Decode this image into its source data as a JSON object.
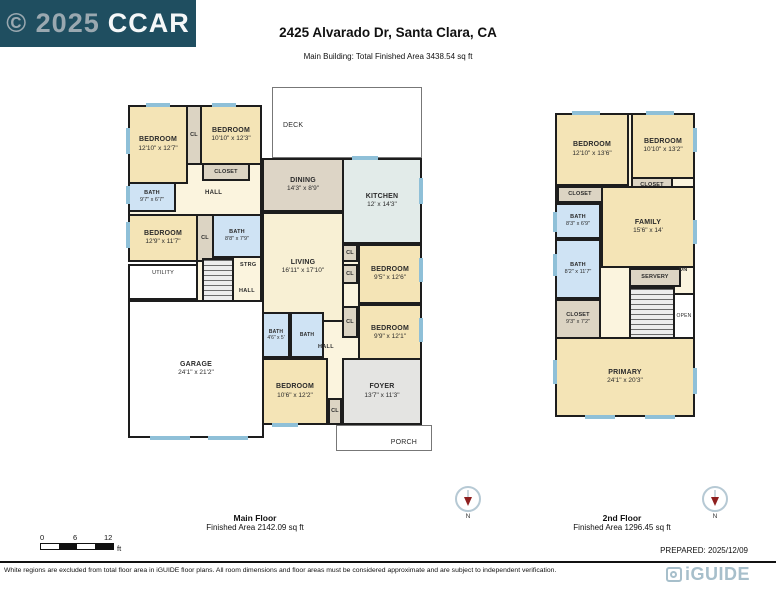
{
  "header": {
    "copyright_prefix": "© 2025",
    "copyright_suffix": "CCAR",
    "title": "2425 Alvarado Dr, Santa Clara, CA",
    "subtitle": "Main Building: Total Finished Area 3438.54 sq ft"
  },
  "main_floor": {
    "title": "Main Floor",
    "area": "Finished Area 2142.09 sq ft",
    "rooms": {
      "deck": "DECK",
      "porch": "PORCH",
      "bedroom1": {
        "name": "BEDROOM",
        "dims": "12'10\" x 12'7\""
      },
      "cl1": "CL",
      "bedroom2": {
        "name": "BEDROOM",
        "dims": "10'10\" x 12'3\""
      },
      "closet1": "CLOSET",
      "bath1": {
        "name": "BATH",
        "dims": "9'7\" x 6'7\""
      },
      "hall1": "HALL",
      "bedroom3": {
        "name": "BEDROOM",
        "dims": "12'9\" x 11'7\""
      },
      "cl2": "CL",
      "bath2": {
        "name": "BATH",
        "dims": "8'8\" x 7'9\""
      },
      "strg": "STRG",
      "hall2": "HALL",
      "utility": "UTILITY",
      "garage": {
        "name": "GARAGE",
        "dims": "24'1\" x 21'2\""
      },
      "dining": {
        "name": "DINING",
        "dims": "14'3\" x 8'9\""
      },
      "kitchen": {
        "name": "KITCHEN",
        "dims": "12' x 14'3\""
      },
      "living": {
        "name": "LIVING",
        "dims": "16'11\" x 17'10\""
      },
      "cl3": "CL",
      "cl4": "CL",
      "bedroom4": {
        "name": "BEDROOM",
        "dims": "9'5\" x 12'6\""
      },
      "cl5": "CL",
      "bedroom5": {
        "name": "BEDROOM",
        "dims": "9'9\" x 12'1\""
      },
      "hall3": "HALL",
      "bath3": {
        "name": "BATH",
        "dims": "4'6\" x 5'"
      },
      "bath4": "BATH",
      "bedroom6": {
        "name": "BEDROOM",
        "dims": "10'6\" x 12'2\""
      },
      "cl6": "CL",
      "foyer": {
        "name": "FOYER",
        "dims": "13'7\" x 11'3\""
      }
    }
  },
  "second_floor": {
    "title": "2nd Floor",
    "area": "Finished Area 1296.45 sq ft",
    "rooms": {
      "bedroomA": {
        "name": "BEDROOM",
        "dims": "12'10\" x 13'6\""
      },
      "bedroomB": {
        "name": "BEDROOM",
        "dims": "10'10\" x 13'2\""
      },
      "closetA": "CLOSET",
      "closetB": "CLOSET",
      "bathA": {
        "name": "BATH",
        "dims": "8'3\" x 6'9\""
      },
      "family": {
        "name": "FAMILY",
        "dims": "15'6\" x 14'"
      },
      "bathB": {
        "name": "BATH",
        "dims": "8'2\" x 11'7\""
      },
      "closetC": {
        "name": "CLOSET",
        "dims": "9'3\" x 7'2\""
      },
      "servery": "SERVERY",
      "dn": "DN",
      "open": "OPEN",
      "primary": {
        "name": "PRIMARY",
        "dims": "24'1\" x 20'3\""
      }
    }
  },
  "compass_label": "N",
  "scale": {
    "t0": "0",
    "t6": "6",
    "t12": "12",
    "unit": "ft"
  },
  "prepared": "PREPARED: 2025/12/09",
  "footer_note": "White regions are excluded from total floor area in iGUIDE floor plans. All room dimensions and floor areas must be considered approximate and are subject to independent verification.",
  "brand": "iGUIDE",
  "colors": {
    "header_bg": "#1f4e60",
    "window_marker": "#8fc0d8",
    "bath_fill": "#cfe3f4",
    "room_fill": "#f4e4b6",
    "brand_color": "#a7bfcb"
  }
}
